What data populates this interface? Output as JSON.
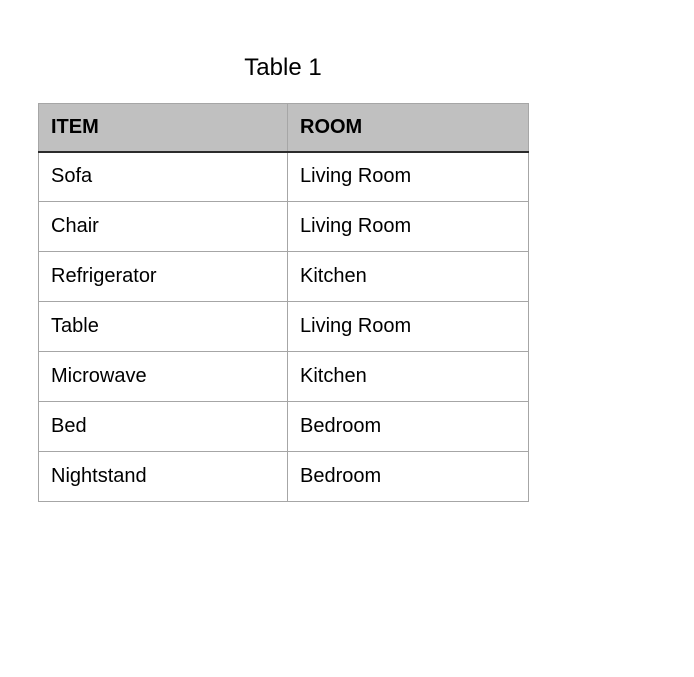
{
  "title": "Table 1",
  "table": {
    "headers": [
      "ITEM",
      "ROOM"
    ],
    "rows": [
      [
        "Sofa",
        "Living Room"
      ],
      [
        "Chair",
        "Living Room"
      ],
      [
        "Refrigerator",
        "Kitchen"
      ],
      [
        "Table",
        "Living Room"
      ],
      [
        "Microwave",
        "Kitchen"
      ],
      [
        "Bed",
        "Bedroom"
      ],
      [
        "Nightstand",
        "Bedroom"
      ]
    ]
  },
  "colors": {
    "header_bg": "#c0c0c0",
    "border": "#a6a6a6",
    "header_underline": "#2b2b2b",
    "text": "#000000",
    "page_bg": "#ffffff"
  }
}
